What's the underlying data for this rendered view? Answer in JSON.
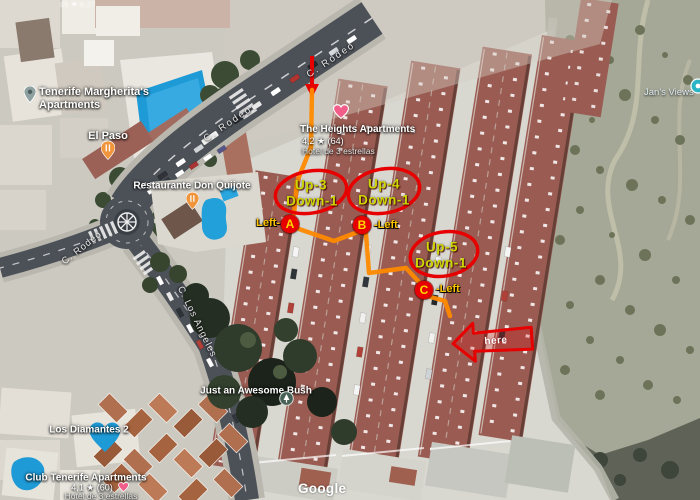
{
  "map": {
    "watermark": "Google",
    "top_fragment": "05 ❤ 8:27",
    "streets": {
      "rodeo_top": "C. Rodeo",
      "rodeo_mid": "C. Rodeo",
      "rodeo_left": "C. Rodeo",
      "los_angeles": "C. Los Angeles"
    },
    "pois": {
      "margheritas": {
        "line1": "Tenerife Margherita's",
        "line2": "Apartments"
      },
      "el_paso": {
        "name": "El Paso"
      },
      "don_quijote": {
        "name": "Restaurante Don Quijote"
      },
      "heights": {
        "name": "The Heights Apartments",
        "rating": "4,2 ★ (64)",
        "category": "Hotel de 3 estrellas"
      },
      "awesome_bush": {
        "name": "Just an Awesome Bush"
      },
      "los_diamantes": {
        "name": "Los Diamantes 2"
      },
      "club_tenerife": {
        "name": "Club Tenerife Apartments",
        "rating": "4,1 ★ (60)",
        "category": "Hotel de 3 estrellas"
      },
      "jans_views": {
        "name": "Jan's Views"
      }
    }
  },
  "annotations": {
    "route_color": "#ff8a00",
    "marker_color": "#e60000",
    "unit_text_color": "#ccd600",
    "side_label_color": "#ffc400",
    "stops": [
      {
        "letter": "A",
        "label": "Left-"
      },
      {
        "letter": "B",
        "label": "-Left"
      },
      {
        "letter": "C",
        "label": "-Left"
      }
    ],
    "units": [
      {
        "line1": "Up-3",
        "line2": "Down-1"
      },
      {
        "line1": "Up-4",
        "line2": "Down-1"
      },
      {
        "line1": "Up-5",
        "line2": "Down-1"
      }
    ],
    "arrow_label": "here"
  }
}
